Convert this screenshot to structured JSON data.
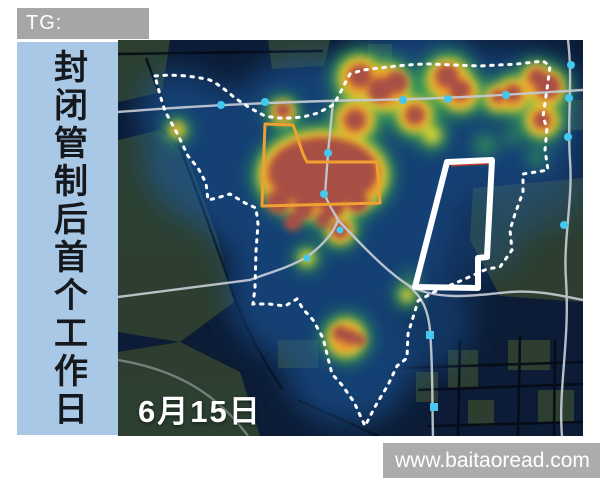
{
  "header": {
    "tg_label": "TG: MYYJJPP"
  },
  "side_banner": {
    "title": "封闭管制后首个工作日"
  },
  "map": {
    "date_label": "6月15日"
  },
  "footer": {
    "watermark": "www.baitaoread.com"
  },
  "legend_semantics": {
    "dashed_white_line": "district-boundary",
    "orange_outline": "managed-zone-outline",
    "white_solid_polygon": "highlighted-area-outline",
    "cyan_dots": "metro-stations",
    "heat_colors": [
      "#1e5fa8",
      "#3aa84f",
      "#e8d832",
      "#ef8c2a",
      "#a84f44"
    ]
  },
  "colors": {
    "banner_gray": "#a6a6a6",
    "banner_blue": "#a9c8e6",
    "map_background": "#0c1c36",
    "park_green": "#33452f",
    "road_gray": "#c5cbd4",
    "station_cyan": "#45c8f0",
    "boundary_white": "#ffffff",
    "zone_orange": "#f0a030",
    "heat_core_red": "#a84f44"
  }
}
